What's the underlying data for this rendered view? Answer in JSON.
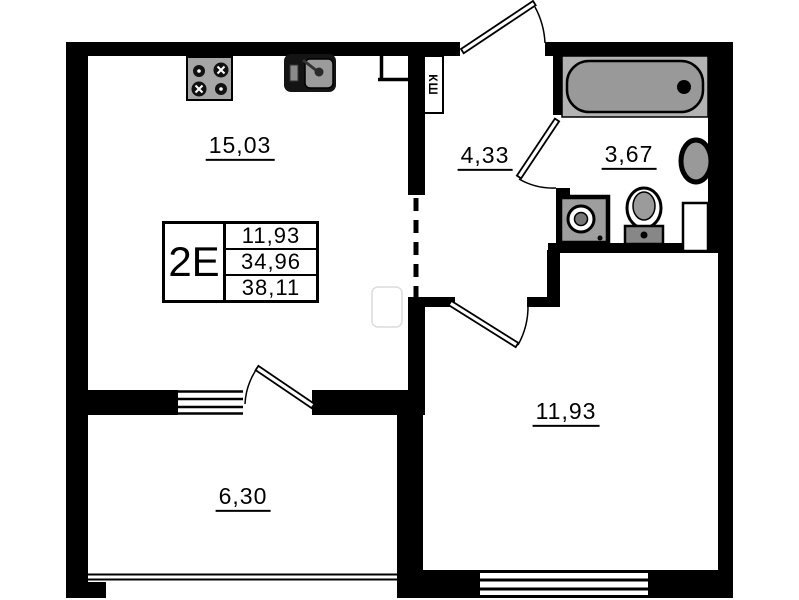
{
  "unit": {
    "type": "2Е",
    "areas": {
      "living": "11,93",
      "apartment": "34,96",
      "total": "38,11"
    }
  },
  "rooms": {
    "kitchen_living": {
      "area": "15,03"
    },
    "hallway": {
      "area": "4,33"
    },
    "bathroom": {
      "area": "3,67"
    },
    "bedroom": {
      "area": "11,93"
    },
    "balcony": {
      "area": "6,30"
    }
  },
  "labels": {
    "shaft": "КШ"
  },
  "colors": {
    "wall": "#000000",
    "fixture_gray": "#9e9e9e",
    "tub_gray": "#b3b3b3",
    "background": "#ffffff"
  }
}
